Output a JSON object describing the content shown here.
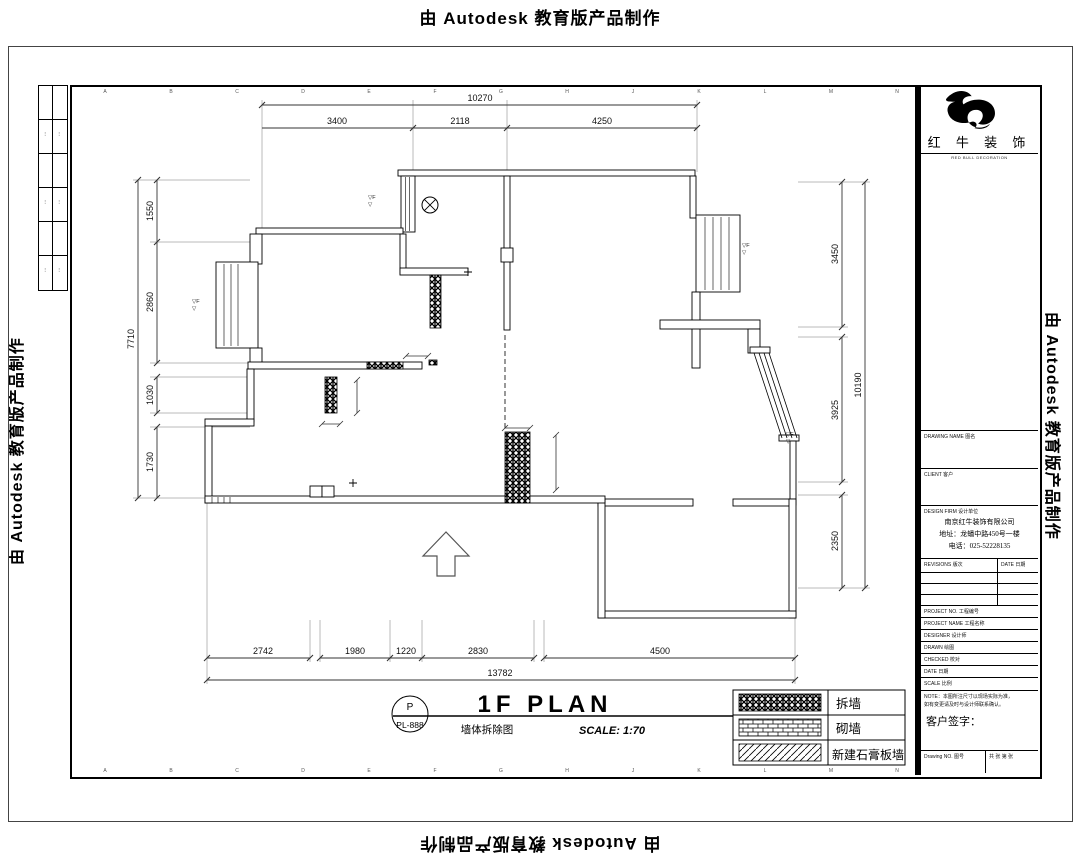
{
  "watermarks": {
    "top": "由 Autodesk 教育版产品制作",
    "bottom": "由 Autodesk 教育版产品制作",
    "left": "由 Autodesk 教育版产品制作",
    "right": "由 Autodesk 教育版产品制作"
  },
  "brand": {
    "name": "红 牛 装 饰",
    "subtitle": "RED BULL DECORATION"
  },
  "title_block": {
    "drawing_name_label": "DRAWING NAME 图名",
    "client_label": "CLIENT 客户",
    "firm_label": "DESIGN FIRM 设计单位",
    "company": {
      "name": "南京红牛装饰有限公司",
      "address": "地址：龙蟠中路450号一楼",
      "phone": "电话：025-52228135"
    },
    "revisions_label": "REVISIONS 版次",
    "rev_date_label": "DATE 日期",
    "fields": [
      {
        "label": "PROJECT NO. 工程编号",
        "value": ""
      },
      {
        "label": "PROJECT NAME 工程名称",
        "value": ""
      },
      {
        "label": "DESIGNER 设计师",
        "value": ""
      },
      {
        "label": "DRAWN 绘图",
        "value": ""
      },
      {
        "label": "CHECKED 校对",
        "value": ""
      },
      {
        "label": "DATE 日期",
        "value": ""
      },
      {
        "label": "SCALE 比例",
        "value": ""
      }
    ],
    "notes": [
      "NOTE：本图所注尺寸以现场实际为准，",
      "如有变更请及时与设计师联系确认。"
    ],
    "signature_label": "客户签字：",
    "drawing_no_label": "Drawing NO. 图号",
    "page_label": "共  张  第  张"
  },
  "side_strip": {
    "cells": [
      "⋯",
      "⋯",
      "⋯",
      "⋯",
      "⋯",
      "⋯"
    ]
  },
  "plan": {
    "dims": {
      "top_total": "10270",
      "top_segments": [
        "3400",
        "2118",
        "4250"
      ],
      "bottom_segments": [
        "2742",
        "1980",
        "1220",
        "2830",
        "4500"
      ],
      "bottom_total": "13782",
      "left_segments": [
        "1550",
        "2860",
        "1030",
        "1730"
      ],
      "left_total": "7710",
      "right_segments": [
        "3450",
        "3925",
        "2350"
      ],
      "right_total": "10190"
    },
    "level_mark": {
      "line1": "▽F",
      "line2": "▽"
    },
    "title": {
      "circle_top": "P",
      "circle_bottom": "PL-888",
      "main": "1F PLAN",
      "sub": "墙体拆除图",
      "scale": "SCALE: 1:70"
    },
    "legend": {
      "rows": [
        {
          "label": "拆墙"
        },
        {
          "label": "砌墙"
        },
        {
          "label": "新建石膏板墙"
        }
      ]
    },
    "grid_letters": [
      "A",
      "B",
      "C",
      "D",
      "E",
      "F",
      "G",
      "H",
      "J",
      "K",
      "L",
      "M",
      "N"
    ]
  }
}
